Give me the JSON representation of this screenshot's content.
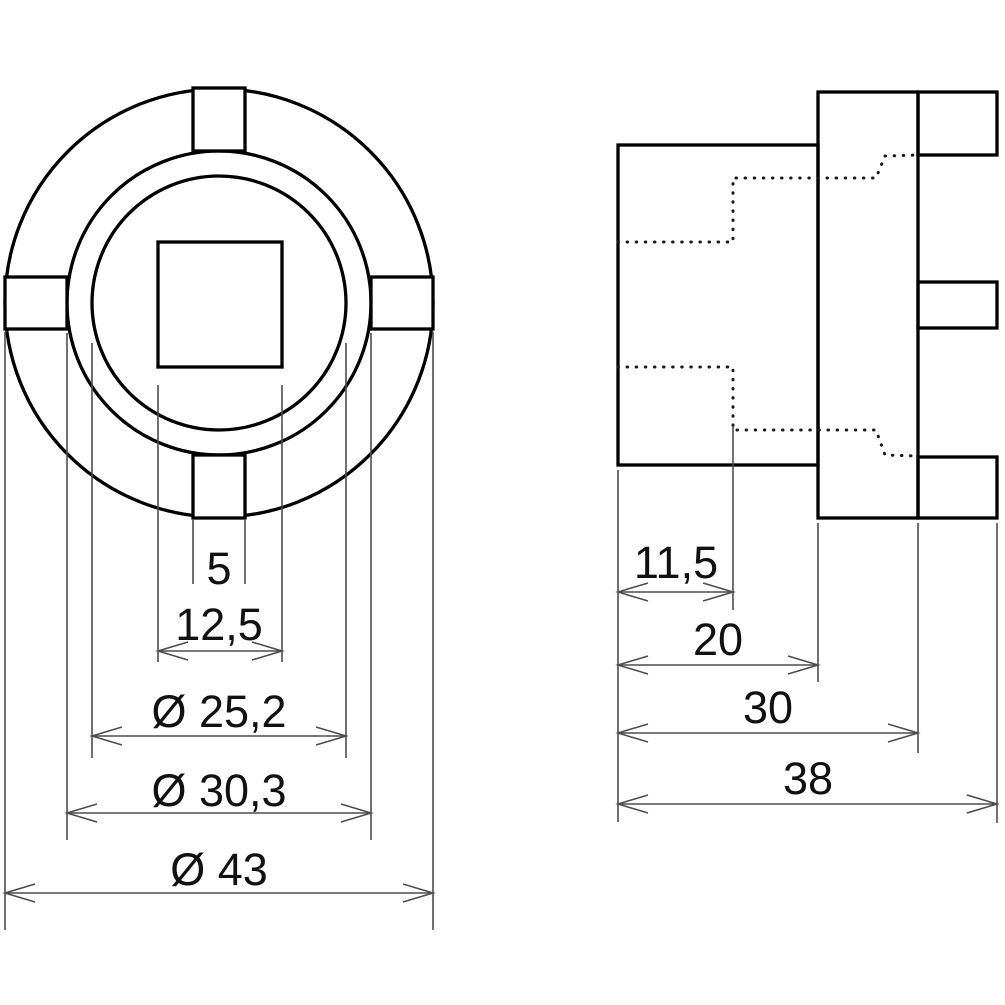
{
  "drawing": {
    "background_color": "#ffffff",
    "outline_color": "#000000",
    "dimension_line_color": "#4d4d4d",
    "text_color": "#111111",
    "front_view": {
      "dimensions": [
        {
          "id": "slot-width",
          "label": "5"
        },
        {
          "id": "square-drive-width",
          "label": "12,5"
        },
        {
          "id": "bore-diameter",
          "label": "Ø 25,2"
        },
        {
          "id": "inner-ring-diameter",
          "label": "Ø 30,3"
        },
        {
          "id": "outer-diameter",
          "label": "Ø 43"
        }
      ]
    },
    "side_view": {
      "dimensions": [
        {
          "id": "square-drive-depth",
          "label": "11,5"
        },
        {
          "id": "body-length",
          "label": "20"
        },
        {
          "id": "length-to-slots",
          "label": "30"
        },
        {
          "id": "overall-length",
          "label": "38"
        }
      ]
    }
  }
}
